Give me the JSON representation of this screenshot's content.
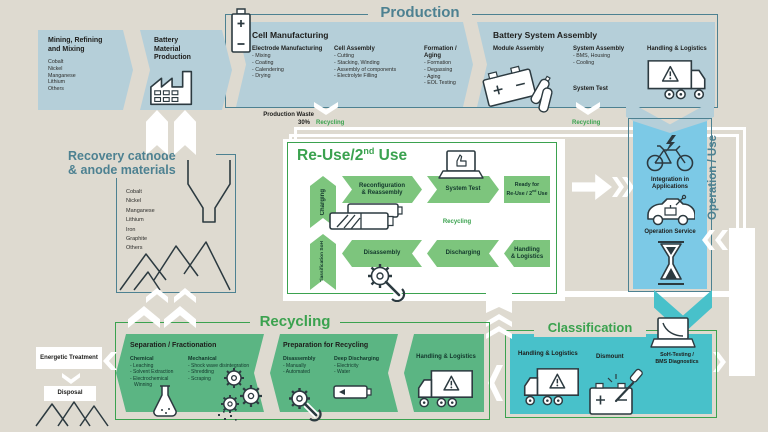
{
  "colors": {
    "background": "#dedad0",
    "production_blue": "#b5cfd9",
    "operation_blue": "#7cc9e6",
    "classification_teal": "#48c1ca",
    "reuse_green": "#7dc57d",
    "recycling_green": "#5bb583",
    "accent_teal": "#4d8191",
    "accent_green": "#3ba24f",
    "ink": "#1d1d1b"
  },
  "production": {
    "title": "Production",
    "mining": {
      "title": "Mining, Refining and Mixing",
      "materials": [
        "Cobalt",
        "Nickel",
        "Manganese",
        "Lithium",
        "Others"
      ]
    },
    "battery_material": {
      "title": "Battery Material Production"
    },
    "cell_manufacturing": {
      "title": "Cell Manufacturing",
      "columns": [
        {
          "header": "Electrode Manufacturing",
          "items": [
            "- Mixing",
            "- Coating",
            "- Calendering",
            "- Drying"
          ]
        },
        {
          "header": "Cell Assembly",
          "items": [
            "- Cutting",
            "- Stacking, Winding",
            "- Assembly of components",
            "- Electrolyte Filling"
          ]
        },
        {
          "header": "Formation / Aging",
          "items": [
            "- Formation",
            "- Degassing",
            "- Aging",
            "- EOL Testing"
          ]
        }
      ]
    },
    "system_assembly": {
      "title": "Battery System Assembly",
      "module_header": "Module Assembly",
      "system_header": "System Assembly",
      "system_items": [
        "- BMS, Housing",
        "- Cooling"
      ],
      "system_test": "System Test",
      "logistics": "Handling & Logistics"
    },
    "waste": {
      "label": "Production Waste",
      "percent": "30%",
      "to": "Recycling"
    },
    "assembly_to": "Recycling"
  },
  "reuse": {
    "title_main": "Re-Use/2",
    "title_sup": "nd",
    "title_tail": " Use",
    "charging": "Charging",
    "classification_l1": "Classification",
    "classification_l2": "SoH",
    "reconfiguration_l1": "Reconfiguration",
    "reconfiguration_l2": "& Reassembly",
    "system_test": "System Test",
    "ready_l1": "Ready for",
    "ready_l2": "Re-Use / 2",
    "ready_sup": "nd",
    "ready_tail": " Use",
    "recycling_label": "Recycling",
    "disassembly": "Disassembly",
    "discharging": "Discharging",
    "logistics_l1": "Handling",
    "logistics_l2": "& Logistics"
  },
  "operation": {
    "title": "Operation / Use",
    "integration": "Integration in Applications",
    "service": "Operation Service"
  },
  "classification": {
    "title": "Classification",
    "logistics": "Handling & Logistics",
    "dismount": "Dismount",
    "soh_l1": "SoH-Testing /",
    "soh_l2": "BMS Diagnostics"
  },
  "recycling": {
    "title": "Recycling",
    "separation": {
      "title": "Separation / Fractionation",
      "chemical_header": "Chemical",
      "chemical_items": [
        "- Leaching",
        "- Solvent Extraction",
        "- Electrochemical Winning"
      ],
      "mechanical_header": "Mechanical",
      "mechanical_items": [
        "- Shock wave disintegration",
        "- Shredding",
        "- Scraping"
      ]
    },
    "preparation": {
      "title": "Preparation for Recycling",
      "disassembly_header": "Disassembly",
      "disassembly_items": [
        "- Manually",
        "- Automated"
      ],
      "discharging_header": "Deep Discharging",
      "discharging_items": [
        "- Electricity",
        "- Water"
      ]
    },
    "logistics": "Handling & Logistics"
  },
  "recovery": {
    "title_l1": "Recovery cathode",
    "title_l2": "& anode materials",
    "materials": [
      "Cobalt",
      "Nickel",
      "Manganese",
      "Lithium",
      "Iron",
      "Graphite",
      "Others"
    ]
  },
  "disposal_flow": {
    "energetic": "Energetic Treatment",
    "disposal": "Disposal"
  },
  "icons": [
    "battery-icon",
    "factory-icon",
    "module-assembly-icon",
    "truck-icon",
    "laptop-thumbsup-icon",
    "battery-pack-icon",
    "gear-wrench-icon",
    "flask-icon",
    "gears-icon",
    "battery-empty-icon",
    "funnel-icon",
    "material-piles-icon",
    "bike-icon",
    "car-icon",
    "hourglass-icon",
    "battery-dismount-icon",
    "laptop-soh-icon",
    "disposal-piles-icon"
  ]
}
